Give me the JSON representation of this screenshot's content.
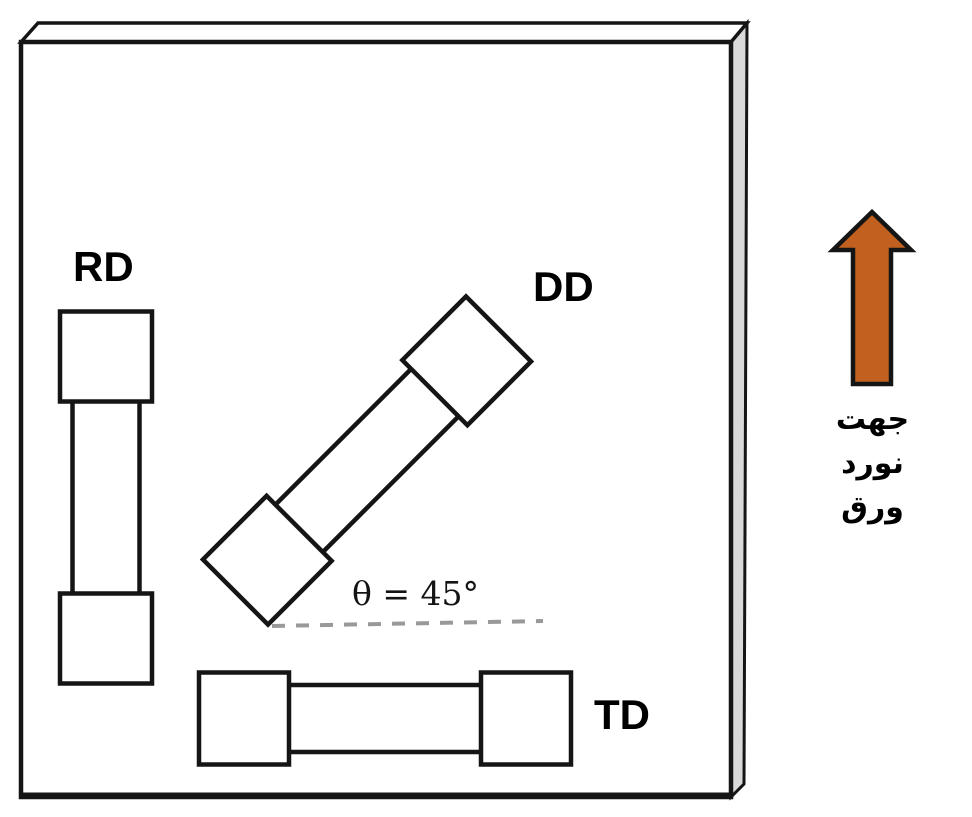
{
  "figure": {
    "labels": {
      "rd": "RD",
      "dd": "DD",
      "td": "TD"
    },
    "angle_annotation": "θ = 45°",
    "caption": {
      "line1": "جهت",
      "line2": "نورد",
      "line3": "ورق"
    },
    "colors": {
      "outline": "#151515",
      "sheet_face": "#ffffff",
      "sheet_side": "#d9d9d9",
      "arrow_fill": "#c2611f",
      "dashed_line": "#999999"
    }
  }
}
